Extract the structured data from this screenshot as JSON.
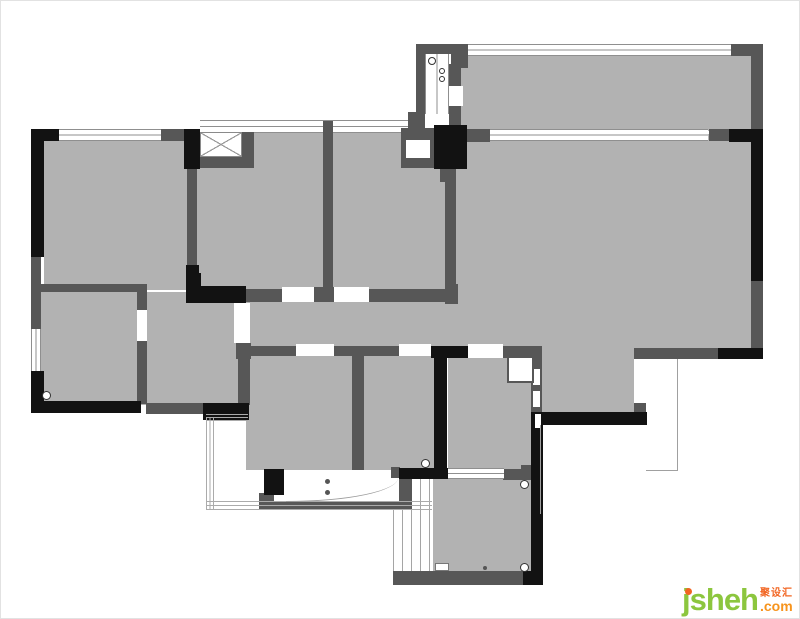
{
  "meta": {
    "width": 800,
    "height": 619,
    "kind": "apartment floor plan"
  },
  "colors": {
    "room_fill": "#b2b2b2",
    "wall_black": "#121212",
    "wall_dark": "#575757",
    "logo_green": "#8cc63e",
    "logo_orange": "#f7941d",
    "logo_orange_dark": "#f26522"
  },
  "logo": {
    "brand": "jsheh",
    "tld": ".com",
    "chinese": "聚设汇"
  },
  "plan": {
    "elements": [
      {
        "cls": "room",
        "name": "room-top-right",
        "x": 455,
        "y": 53,
        "w": 297,
        "h": 77
      },
      {
        "cls": "room",
        "name": "room-right-large",
        "x": 450,
        "y": 133,
        "w": 302,
        "h": 215
      },
      {
        "cls": "room",
        "name": "room-right-lower",
        "x": 532,
        "y": 345,
        "w": 101,
        "h": 68
      },
      {
        "cls": "room",
        "name": "room-bed-left",
        "x": 43,
        "y": 139,
        "w": 143,
        "h": 150
      },
      {
        "cls": "room",
        "name": "room-bed-mid",
        "x": 196,
        "y": 131,
        "w": 126,
        "h": 162
      },
      {
        "cls": "room",
        "name": "room-bed-right",
        "x": 332,
        "y": 131,
        "w": 112,
        "h": 162
      },
      {
        "cls": "room",
        "name": "hallway",
        "x": 140,
        "y": 291,
        "w": 317,
        "h": 57
      },
      {
        "cls": "room",
        "name": "room-mid-small",
        "x": 140,
        "y": 291,
        "w": 106,
        "h": 113
      },
      {
        "cls": "room",
        "name": "room-bottom-left",
        "x": 40,
        "y": 291,
        "w": 96,
        "h": 111
      },
      {
        "cls": "room",
        "name": "room-bottom-center",
        "x": 245,
        "y": 353,
        "w": 110,
        "h": 116
      },
      {
        "cls": "room",
        "name": "room-bottom-mid",
        "x": 361,
        "y": 353,
        "w": 74,
        "h": 116
      },
      {
        "cls": "room",
        "name": "bathroom",
        "x": 447,
        "y": 353,
        "w": 85,
        "h": 116
      },
      {
        "cls": "room",
        "name": "room-bottom-right",
        "x": 432,
        "y": 477,
        "w": 99,
        "h": 95
      },
      {
        "cls": "win-h",
        "name": "window",
        "x": 58,
        "y": 128,
        "w": 102,
        "h": 12
      },
      {
        "cls": "win-h",
        "name": "window",
        "x": 199,
        "y": 119,
        "w": 209,
        "h": 13
      },
      {
        "cls": "win-h",
        "name": "window",
        "x": 467,
        "y": 43,
        "w": 263,
        "h": 12
      },
      {
        "cls": "win-h",
        "name": "window",
        "x": 487,
        "y": 128,
        "w": 220,
        "h": 12
      },
      {
        "cls": "win-v",
        "name": "window",
        "x": 30,
        "y": 328,
        "w": 10,
        "h": 42
      },
      {
        "cls": "win-v",
        "name": "duct-window",
        "x": 424,
        "y": 53,
        "w": 24,
        "h": 60
      },
      {
        "cls": "glaz-v",
        "name": "window-glazing",
        "x": 392,
        "y": 477,
        "w": 40,
        "h": 93
      },
      {
        "cls": "walld",
        "x": 160,
        "y": 128,
        "w": 25,
        "h": 12
      },
      {
        "cls": "walld",
        "x": 186,
        "y": 166,
        "w": 10,
        "h": 102
      },
      {
        "cls": "walld",
        "x": 415,
        "y": 43,
        "w": 52,
        "h": 10
      },
      {
        "cls": "walld",
        "x": 450,
        "y": 50,
        "w": 17,
        "h": 17
      },
      {
        "cls": "walld",
        "x": 415,
        "y": 50,
        "w": 9,
        "h": 64
      },
      {
        "cls": "walld",
        "x": 407,
        "y": 111,
        "w": 17,
        "h": 32
      },
      {
        "cls": "walld",
        "x": 448,
        "y": 63,
        "w": 12,
        "h": 23
      },
      {
        "cls": "walld",
        "x": 448,
        "y": 105,
        "w": 12,
        "h": 23
      },
      {
        "cls": "walld",
        "x": 465,
        "y": 128,
        "w": 24,
        "h": 13
      },
      {
        "cls": "walld",
        "x": 439,
        "y": 166,
        "w": 14,
        "h": 15
      },
      {
        "cls": "walld",
        "name": "duct-box",
        "x": 400,
        "y": 127,
        "w": 34,
        "h": 40
      },
      {
        "cls": "gap",
        "x": 405,
        "y": 139,
        "w": 24,
        "h": 18
      },
      {
        "cls": "walld",
        "x": 730,
        "y": 43,
        "w": 32,
        "h": 12
      },
      {
        "cls": "walld",
        "x": 750,
        "y": 50,
        "w": 12,
        "h": 80
      },
      {
        "cls": "walld",
        "x": 708,
        "y": 128,
        "w": 22,
        "h": 12
      },
      {
        "cls": "walld",
        "x": 750,
        "y": 278,
        "w": 12,
        "h": 70
      },
      {
        "cls": "walld",
        "x": 705,
        "y": 347,
        "w": 14,
        "h": 11
      },
      {
        "cls": "walld",
        "x": 633,
        "y": 347,
        "w": 86,
        "h": 11
      },
      {
        "cls": "walld",
        "x": 633,
        "y": 402,
        "w": 12,
        "h": 11
      },
      {
        "cls": "walld",
        "x": 530,
        "y": 345,
        "w": 11,
        "h": 67
      },
      {
        "cls": "walld",
        "x": 502,
        "y": 345,
        "w": 38,
        "h": 12
      },
      {
        "cls": "walld",
        "x": 502,
        "y": 468,
        "w": 30,
        "h": 11
      },
      {
        "cls": "walld",
        "x": 520,
        "y": 464,
        "w": 11,
        "h": 15
      },
      {
        "cls": "walld",
        "x": 245,
        "y": 288,
        "w": 36,
        "h": 13
      },
      {
        "cls": "walld",
        "x": 313,
        "y": 286,
        "w": 20,
        "h": 15
      },
      {
        "cls": "walld",
        "x": 368,
        "y": 288,
        "w": 78,
        "h": 13
      },
      {
        "cls": "walld",
        "x": 444,
        "y": 283,
        "w": 13,
        "h": 20
      },
      {
        "cls": "walld",
        "x": 444,
        "y": 163,
        "w": 11,
        "h": 126
      },
      {
        "cls": "walld",
        "x": 322,
        "y": 120,
        "w": 10,
        "h": 174
      },
      {
        "cls": "walld",
        "x": 245,
        "y": 345,
        "w": 50,
        "h": 10
      },
      {
        "cls": "walld",
        "x": 333,
        "y": 345,
        "w": 65,
        "h": 10
      },
      {
        "cls": "walld",
        "x": 351,
        "y": 353,
        "w": 12,
        "h": 116
      },
      {
        "cls": "walld",
        "x": 136,
        "y": 283,
        "w": 10,
        "h": 26
      },
      {
        "cls": "walld",
        "x": 136,
        "y": 340,
        "w": 10,
        "h": 63
      },
      {
        "cls": "walld",
        "x": 235,
        "y": 342,
        "w": 15,
        "h": 16
      },
      {
        "cls": "walld",
        "x": 237,
        "y": 358,
        "w": 12,
        "h": 46
      },
      {
        "cls": "walld",
        "x": 145,
        "y": 402,
        "w": 58,
        "h": 11
      },
      {
        "cls": "walld",
        "x": 30,
        "y": 256,
        "w": 10,
        "h": 72
      },
      {
        "cls": "walld",
        "x": 38,
        "y": 283,
        "w": 100,
        "h": 8
      },
      {
        "cls": "walld",
        "x": 392,
        "y": 570,
        "w": 140,
        "h": 14
      },
      {
        "cls": "walld",
        "x": 398,
        "y": 470,
        "w": 13,
        "h": 38
      },
      {
        "cls": "walld",
        "x": 263,
        "y": 500,
        "w": 148,
        "h": 9
      },
      {
        "cls": "walld",
        "x": 390,
        "y": 466,
        "w": 9,
        "h": 12
      },
      {
        "cls": "walld",
        "x": 258,
        "y": 492,
        "w": 15,
        "h": 16
      },
      {
        "cls": "walld",
        "x": 240,
        "y": 131,
        "w": 13,
        "h": 36
      },
      {
        "cls": "walld",
        "x": 198,
        "y": 155,
        "w": 55,
        "h": 12
      },
      {
        "cls": "wallb",
        "x": 30,
        "y": 128,
        "w": 28,
        "h": 12
      },
      {
        "cls": "wallb",
        "x": 30,
        "y": 128,
        "w": 13,
        "h": 128
      },
      {
        "cls": "wallb",
        "x": 30,
        "y": 370,
        "w": 13,
        "h": 42
      },
      {
        "cls": "wallb",
        "x": 30,
        "y": 400,
        "w": 110,
        "h": 12
      },
      {
        "cls": "wallb",
        "x": 183,
        "y": 128,
        "w": 16,
        "h": 40
      },
      {
        "cls": "wallb",
        "x": 185,
        "y": 264,
        "w": 13,
        "h": 24
      },
      {
        "cls": "wallb",
        "x": 433,
        "y": 124,
        "w": 33,
        "h": 44
      },
      {
        "cls": "wallb",
        "x": 728,
        "y": 128,
        "w": 34,
        "h": 13
      },
      {
        "cls": "wallb",
        "x": 750,
        "y": 128,
        "w": 12,
        "h": 152
      },
      {
        "cls": "wallb",
        "x": 717,
        "y": 347,
        "w": 45,
        "h": 11
      },
      {
        "cls": "wallb",
        "x": 530,
        "y": 411,
        "w": 116,
        "h": 13
      },
      {
        "cls": "wallb",
        "x": 530,
        "y": 411,
        "w": 12,
        "h": 173
      },
      {
        "cls": "wallb",
        "x": 430,
        "y": 345,
        "w": 37,
        "h": 12
      },
      {
        "cls": "wallb",
        "x": 433,
        "y": 353,
        "w": 13,
        "h": 125
      },
      {
        "cls": "wallb",
        "x": 398,
        "y": 467,
        "w": 50,
        "h": 11
      },
      {
        "cls": "wallb",
        "x": 185,
        "y": 285,
        "w": 60,
        "h": 17
      },
      {
        "cls": "wallb",
        "x": 185,
        "y": 272,
        "w": 15,
        "h": 15
      },
      {
        "cls": "wallb",
        "x": 202,
        "y": 402,
        "w": 46,
        "h": 17
      },
      {
        "cls": "wallb",
        "x": 263,
        "y": 468,
        "w": 20,
        "h": 26
      },
      {
        "cls": "wallb",
        "x": 522,
        "y": 570,
        "w": 20,
        "h": 14
      },
      {
        "cls": "gap",
        "x": 281,
        "y": 286,
        "w": 32,
        "h": 15
      },
      {
        "cls": "gap",
        "x": 333,
        "y": 286,
        "w": 35,
        "h": 15
      },
      {
        "cls": "gap",
        "x": 295,
        "y": 343,
        "w": 38,
        "h": 12
      },
      {
        "cls": "gap",
        "x": 398,
        "y": 343,
        "w": 32,
        "h": 12
      },
      {
        "cls": "gap",
        "x": 467,
        "y": 343,
        "w": 35,
        "h": 14
      },
      {
        "cls": "gap",
        "x": 136,
        "y": 309,
        "w": 10,
        "h": 31
      },
      {
        "cls": "gap",
        "x": 233,
        "y": 302,
        "w": 16,
        "h": 40
      },
      {
        "cls": "gap",
        "x": 448,
        "y": 85,
        "w": 14,
        "h": 20
      },
      {
        "cls": "gap",
        "x": 284,
        "y": 477,
        "w": 114,
        "h": 23
      },
      {
        "cls": "win-h",
        "name": "sliding-door",
        "x": 447,
        "y": 467,
        "w": 56,
        "h": 11
      },
      {
        "cls": "gap",
        "x": 532,
        "y": 368,
        "w": 7,
        "h": 16
      },
      {
        "cls": "gap",
        "x": 532,
        "y": 390,
        "w": 7,
        "h": 16
      },
      {
        "cls": "gap",
        "x": 534,
        "y": 413,
        "w": 6,
        "h": 14
      },
      {
        "cls": "xbox",
        "name": "shaft-symbol",
        "x": 199,
        "y": 131,
        "w": 42,
        "h": 25
      },
      {
        "cls": "shower",
        "name": "fixture-box",
        "x": 506,
        "y": 355,
        "w": 27,
        "h": 27
      },
      {
        "cls": "rail-v",
        "name": "balcony-railing",
        "x": 205,
        "y": 416,
        "w": 8,
        "h": 92
      },
      {
        "cls": "rail-h",
        "name": "balcony-railing",
        "x": 205,
        "y": 500,
        "w": 226,
        "h": 9
      },
      {
        "cls": "rail-h",
        "name": "balcony-railing",
        "x": 205,
        "y": 413,
        "w": 42,
        "h": 7
      },
      {
        "cls": "line",
        "x": 539,
        "y": 424,
        "w": 1,
        "h": 89
      },
      {
        "cls": "line",
        "x": 676,
        "y": 358,
        "w": 1,
        "h": 112
      },
      {
        "cls": "line",
        "x": 645,
        "y": 469,
        "w": 32,
        "h": 1
      },
      {
        "cls": "arc",
        "name": "door-swing",
        "x": 285,
        "y": 477,
        "w": 112,
        "h": 24
      },
      {
        "cls": "hinge",
        "x": 427,
        "y": 56,
        "w": 8,
        "h": 8
      },
      {
        "cls": "hinge",
        "x": 438,
        "y": 67,
        "w": 6,
        "h": 6
      },
      {
        "cls": "hinge",
        "x": 438,
        "y": 75,
        "w": 6,
        "h": 6
      },
      {
        "cls": "hinge",
        "x": 41,
        "y": 390,
        "w": 9,
        "h": 9
      },
      {
        "cls": "hinge",
        "x": 420,
        "y": 458,
        "w": 9,
        "h": 9
      },
      {
        "cls": "hinge",
        "x": 519,
        "y": 479,
        "w": 9,
        "h": 9
      },
      {
        "cls": "hinge",
        "x": 519,
        "y": 562,
        "w": 9,
        "h": 9
      },
      {
        "cls": "dot",
        "x": 482,
        "y": 565,
        "w": 4,
        "h": 4
      },
      {
        "cls": "dot",
        "x": 324,
        "y": 478,
        "w": 5,
        "h": 5
      },
      {
        "cls": "dot",
        "x": 324,
        "y": 489,
        "w": 5,
        "h": 5
      },
      {
        "cls": "fixture",
        "x": 434,
        "y": 562,
        "w": 14,
        "h": 8
      }
    ]
  }
}
